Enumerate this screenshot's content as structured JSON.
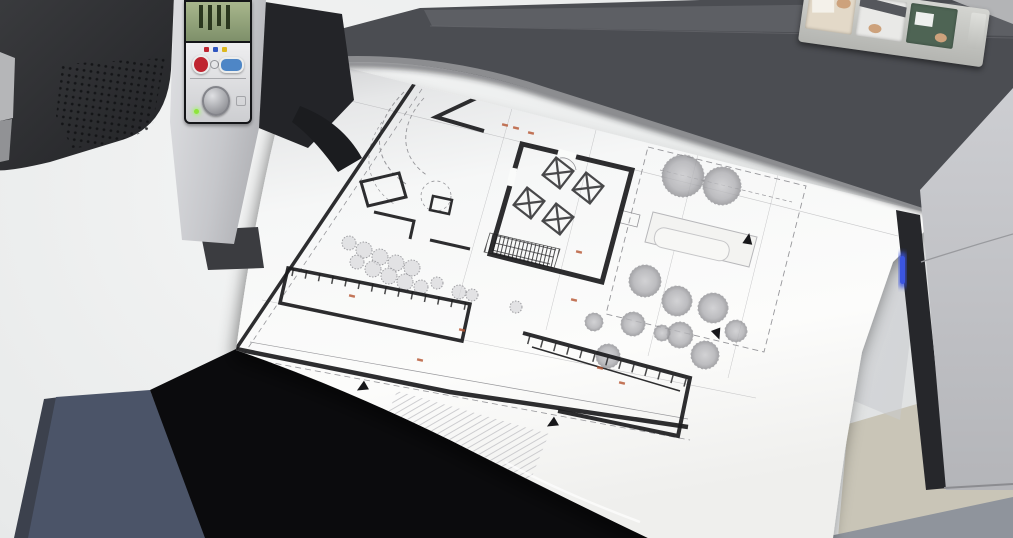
{
  "scene": {
    "description": "Photograph of a large-format inkjet plotter printing a black-and-white architectural site plan onto a wide curling sheet of paper; the plotter's dark gray body spans the top, its small control panel with a green ink-level display sits at the left, a strip of quick-reference picture cards rests on top, and the sheet drapes over a white desk above a dark stand with a beige floor at lower right.",
    "objects": [
      "large-format-plotter",
      "printed-site-plan-sheet",
      "plotter-control-panel",
      "quick-reference-card-strip",
      "office-desk",
      "second-dark-device",
      "under-desk-stand"
    ]
  },
  "palette": {
    "desk": "#eceeee",
    "desk_shade": "#d9dbdc",
    "paper": "#fafbfa",
    "paper_shadow": "#c7c8ca",
    "printer_front": "#4b4d52",
    "printer_top": "#5d5f64",
    "printer_deep": "#37383d",
    "corner_light": "#b3b4b6",
    "platen": "#8c8d90",
    "device_dark": "#2c2d30",
    "panel_light": "#cfd0d4",
    "frame_dark": "#141518",
    "lcd_green": "#7e906a",
    "lcd_bar": "#2a371e",
    "keys_light": "#eeeef0",
    "leg_panel": "#c6c7cb",
    "leg_edge": "#26272b",
    "slate": "#4b5468",
    "black": "#0b0b0d",
    "floor": "#c9c5b7",
    "baseboard": "#8f949c",
    "card_strip": "#b4b5b1",
    "wall_ink": "#1b1b1d",
    "thin_ink": "#96969a",
    "red_ink": "#b5542f",
    "tree_fill": "#b9b9bd",
    "hatch": "#c3c3c7"
  },
  "printer": {
    "status_led_color": "#3b55e0",
    "control_panel": {
      "lcd_bars": [
        "23px",
        "25px",
        "21px",
        "24px"
      ],
      "ink_dots": [
        "#bf2430",
        "#2f55c0",
        "#ddb81e"
      ],
      "buttons": [
        {
          "name": "cancel",
          "color": "#bf2430",
          "shape": "round"
        },
        {
          "name": "ok",
          "color": "#4e86c6",
          "shape": "oval"
        },
        {
          "name": "feed",
          "color": "#b9babd",
          "shape": "round-large"
        }
      ],
      "power_led_color": "#8fe43c"
    },
    "cards": [
      {
        "art": "load-paper",
        "bg": "#e3d9c8"
      },
      {
        "art": "printer-setup",
        "bg": "#e9e9e7"
      },
      {
        "art": "panel-screen",
        "bg": "#4e6454"
      }
    ]
  },
  "floorplan": {
    "description": "Architectural site plan: thick-walled building with central hall and four square skylights, angled upper wing, long lower service wings, hatched terrace and stair, tree and shrub planting, dashed property and setback lines, small red dimension marks and black orientation markers.",
    "features": [
      "building-outline",
      "central-hall",
      "skylights",
      "angled-wing",
      "service-wing",
      "terrace-hatch",
      "stair",
      "trees",
      "shrubs",
      "property-lines",
      "patio",
      "red-dimension-marks",
      "orientation-markers"
    ],
    "skylights": [
      {
        "tf": "translate(558,173) rotate(38)"
      },
      {
        "tf": "translate(588,188) rotate(38)"
      },
      {
        "tf": "translate(529,203) rotate(38)"
      },
      {
        "tf": "translate(558,219) rotate(38)"
      }
    ],
    "trees": [
      {
        "cx": 683,
        "cy": 176,
        "r": 21
      },
      {
        "cx": 722,
        "cy": 186,
        "r": 19
      },
      {
        "cx": 645,
        "cy": 281,
        "r": 16
      },
      {
        "cx": 677,
        "cy": 301,
        "r": 15
      },
      {
        "cx": 713,
        "cy": 308,
        "r": 15
      },
      {
        "cx": 633,
        "cy": 324,
        "r": 12
      },
      {
        "cx": 680,
        "cy": 335,
        "r": 13
      },
      {
        "cx": 705,
        "cy": 355,
        "r": 14
      },
      {
        "cx": 736,
        "cy": 331,
        "r": 11
      },
      {
        "cx": 608,
        "cy": 356,
        "r": 12
      },
      {
        "cx": 594,
        "cy": 322,
        "r": 9
      },
      {
        "cx": 662,
        "cy": 333,
        "r": 8
      }
    ],
    "shrubs": [
      {
        "cx": 349,
        "cy": 243,
        "r": 7
      },
      {
        "cx": 364,
        "cy": 250,
        "r": 8
      },
      {
        "cx": 380,
        "cy": 257,
        "r": 8
      },
      {
        "cx": 396,
        "cy": 263,
        "r": 8
      },
      {
        "cx": 412,
        "cy": 268,
        "r": 8
      },
      {
        "cx": 357,
        "cy": 262,
        "r": 7
      },
      {
        "cx": 373,
        "cy": 269,
        "r": 8
      },
      {
        "cx": 389,
        "cy": 276,
        "r": 8
      },
      {
        "cx": 405,
        "cy": 282,
        "r": 8
      },
      {
        "cx": 421,
        "cy": 287,
        "r": 7
      },
      {
        "cx": 437,
        "cy": 283,
        "r": 6
      },
      {
        "cx": 459,
        "cy": 292,
        "r": 7
      },
      {
        "cx": 472,
        "cy": 295,
        "r": 6
      },
      {
        "cx": 516,
        "cy": 307,
        "r": 6
      }
    ],
    "markers": [
      {
        "tf": "translate(350,152) rotate(-115)"
      },
      {
        "tf": "translate(748,240) rotate(10)"
      },
      {
        "tf": "translate(717,333) rotate(160)"
      },
      {
        "tf": "translate(553,423) rotate(-120)"
      },
      {
        "tf": "translate(363,387) rotate(-120)"
      }
    ],
    "red_marks": [
      {
        "tf": "translate(516,128) rotate(14)"
      },
      {
        "tf": "translate(531,133) rotate(14)"
      },
      {
        "tf": "translate(505,125) rotate(14)"
      },
      {
        "tf": "translate(579,252) rotate(14)"
      },
      {
        "tf": "translate(600,368) rotate(14)"
      },
      {
        "tf": "translate(622,383) rotate(14)"
      },
      {
        "tf": "translate(462,330) rotate(14)"
      },
      {
        "tf": "translate(420,360) rotate(14)"
      },
      {
        "tf": "translate(574,300) rotate(14)"
      },
      {
        "tf": "translate(352,296) rotate(14)"
      }
    ]
  }
}
